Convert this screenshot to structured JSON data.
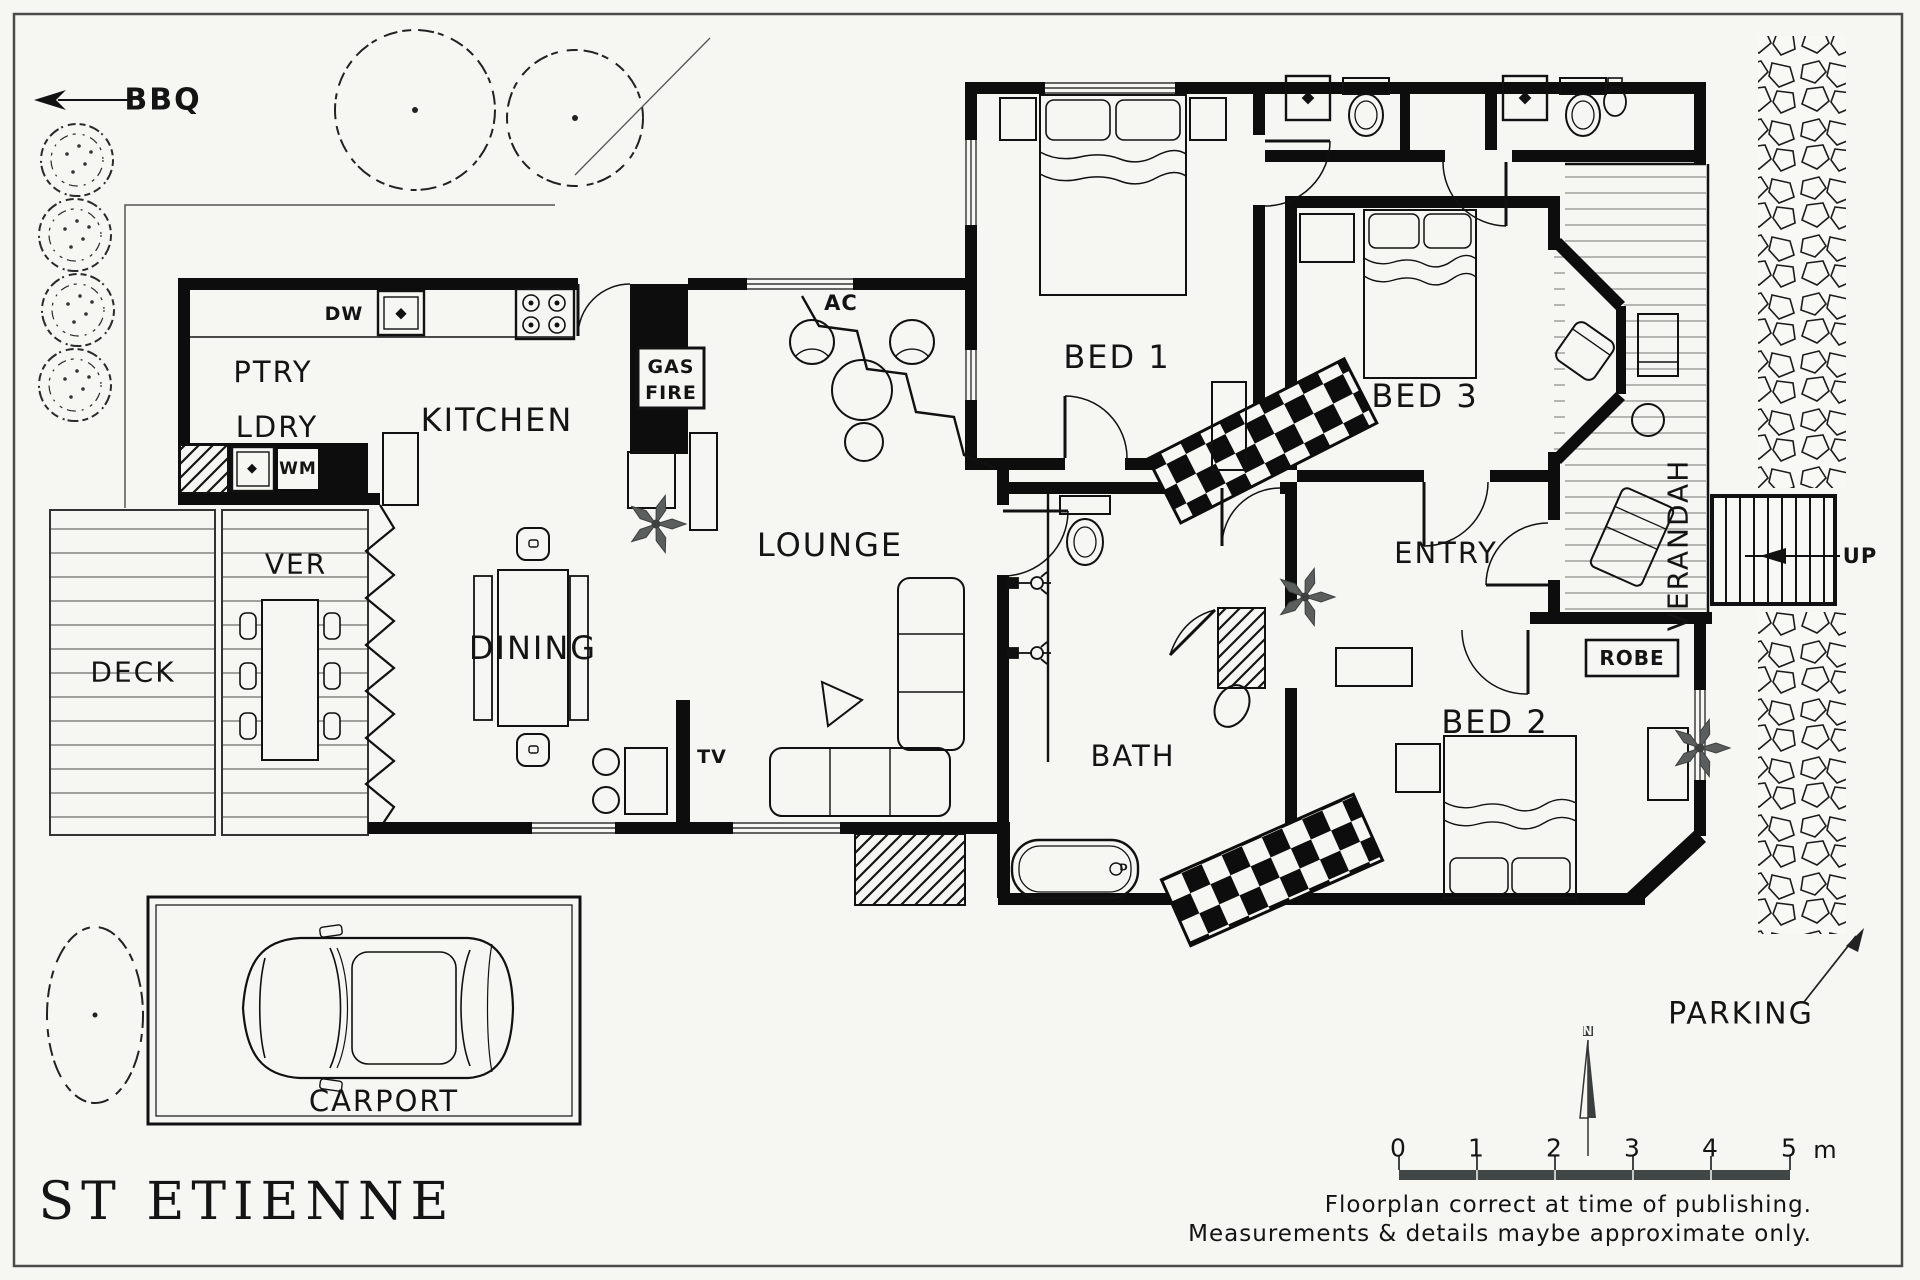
{
  "title": "ST ETIENNE",
  "site": {
    "bbq": "BBQ",
    "parking": "PARKING",
    "carport": "CARPORT",
    "deck": "DECK",
    "ver": "VER",
    "verandah": "VERANDAH",
    "up": "UP"
  },
  "rooms": {
    "ptry": "PTRY",
    "ldry": "LDRY",
    "kitchen": "KITCHEN",
    "dining": "DINING",
    "lounge": "LOUNGE",
    "entry": "ENTRY",
    "bath": "BATH",
    "bed1": "BED 1",
    "bed2": "BED 2",
    "bed3": "BED 3",
    "robe": "ROBE"
  },
  "fixtures": {
    "dw": "DW",
    "wm": "WM",
    "gas": "GAS",
    "fire": "FIRE",
    "ac": "AC",
    "tv": "TV",
    "drain": "D"
  },
  "compass": {
    "north": "N"
  },
  "scalebar": {
    "ticks": [
      "0",
      "1",
      "2",
      "3",
      "4",
      "5"
    ],
    "unit": "m"
  },
  "footer": {
    "line1": "Floorplan correct at time of publishing.",
    "line2": "Measurements & details maybe approximate only."
  }
}
